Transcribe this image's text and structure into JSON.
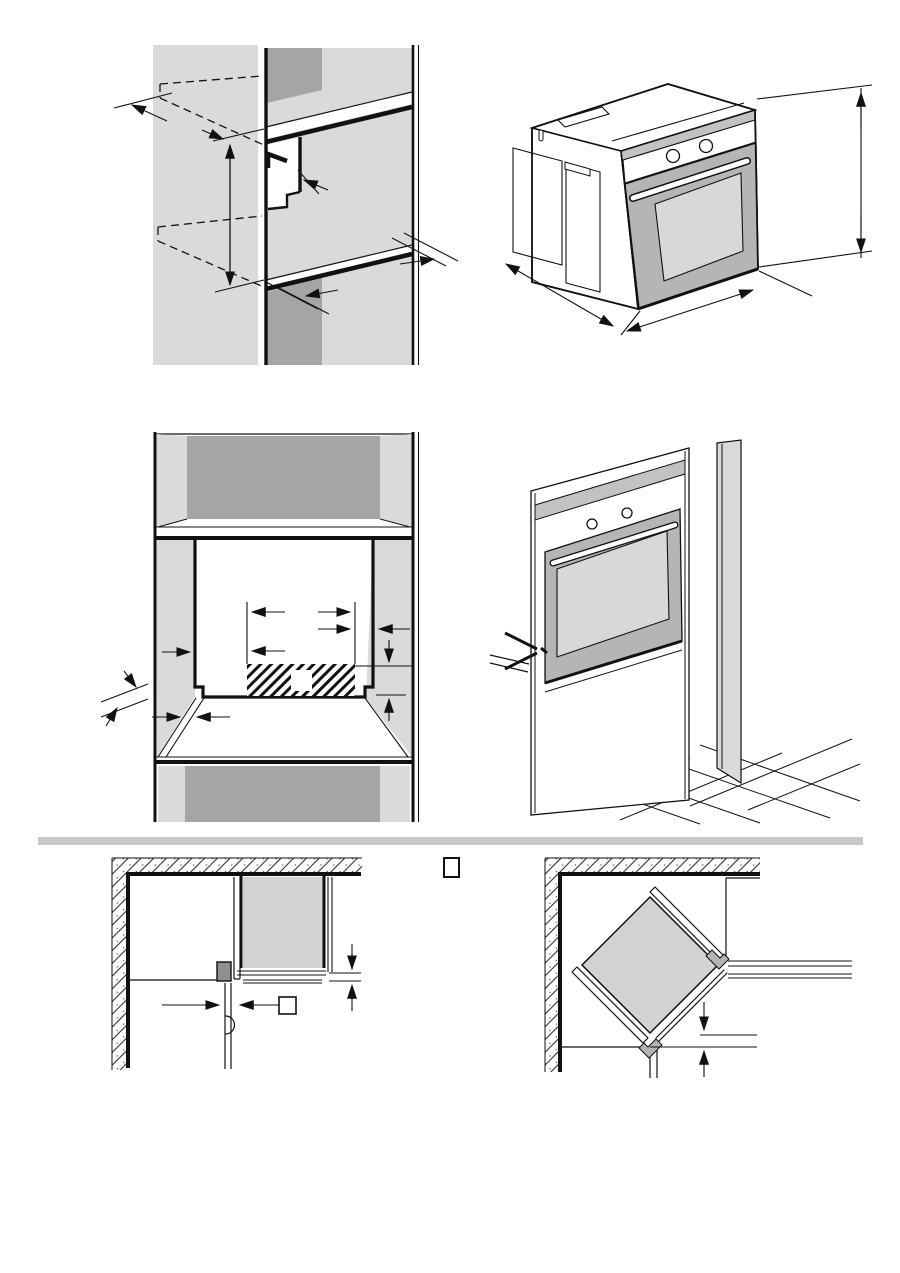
{
  "page": {
    "width": 900,
    "height": 1273,
    "background": "#ffffff"
  },
  "colors": {
    "line": "#111111",
    "panel_light": "#dadada",
    "panel_dark": "#a5a5a5",
    "fascia_gray": "#c2c2c2",
    "door_gray": "#b5b5b5",
    "window_gray": "#d8d8d8",
    "oven_plan_gray": "#d2d2d2",
    "divider_gray": "#c9c9c9",
    "hinge_gray": "#8f8f8f",
    "bracket_gray": "#b3b3b3"
  },
  "diagrams": [
    {
      "id": "niche-side-section",
      "position": "top-left",
      "features": [
        "side-wall-panels",
        "two-shelves",
        "dashed-hidden-shelf-outlines",
        "cable-channel-cutout",
        "vertical-height-dimension-arrow",
        "edge-dimension-arrows"
      ]
    },
    {
      "id": "oven-dimensions-isometric",
      "position": "top-right",
      "features": [
        "oven-body",
        "control-knobs",
        "door-handle",
        "door-window",
        "height-dimension-arrows",
        "width-dimension-arrows",
        "depth-dimension-arrow"
      ]
    },
    {
      "id": "installation-niche-front",
      "position": "middle-left",
      "features": [
        "upper-compartment",
        "niche-opening",
        "hatched-connection-zone",
        "empty-dimension-square",
        "horizontal-dimension-arrows",
        "vertical-dimension-arrows",
        "shelf-thickness-arrows"
      ]
    },
    {
      "id": "oven-installed-tall-cabinet",
      "position": "middle-right",
      "features": [
        "tall-cabinet-column",
        "oven-front",
        "control-knobs",
        "door-handle",
        "fixing-screw-pointer",
        "tiled-floor"
      ]
    },
    {
      "id": "corner-installation-plan",
      "position": "bottom-left",
      "features": [
        "hatched-walls",
        "oven-top-view",
        "hinge-block",
        "open-door",
        "door-swing-arc",
        "dimension-arrows",
        "empty-dimension-box"
      ]
    },
    {
      "id": "diagonal-corner-installation-plan",
      "position": "bottom-right",
      "features": [
        "hatched-walls",
        "oven-rotated-45deg",
        "side-panel-strips",
        "fixing-brackets",
        "adjacent-cabinets",
        "dimension-arrows"
      ]
    }
  ],
  "divider": {
    "style": "horizontal-gray-bar",
    "color": "#c9c9c9"
  },
  "dimension_label_boxes": [
    {
      "id": "box-top-center",
      "content": ""
    },
    {
      "id": "box-corner-plan",
      "content": ""
    },
    {
      "id": "box-niche-hatch",
      "content": ""
    }
  ]
}
